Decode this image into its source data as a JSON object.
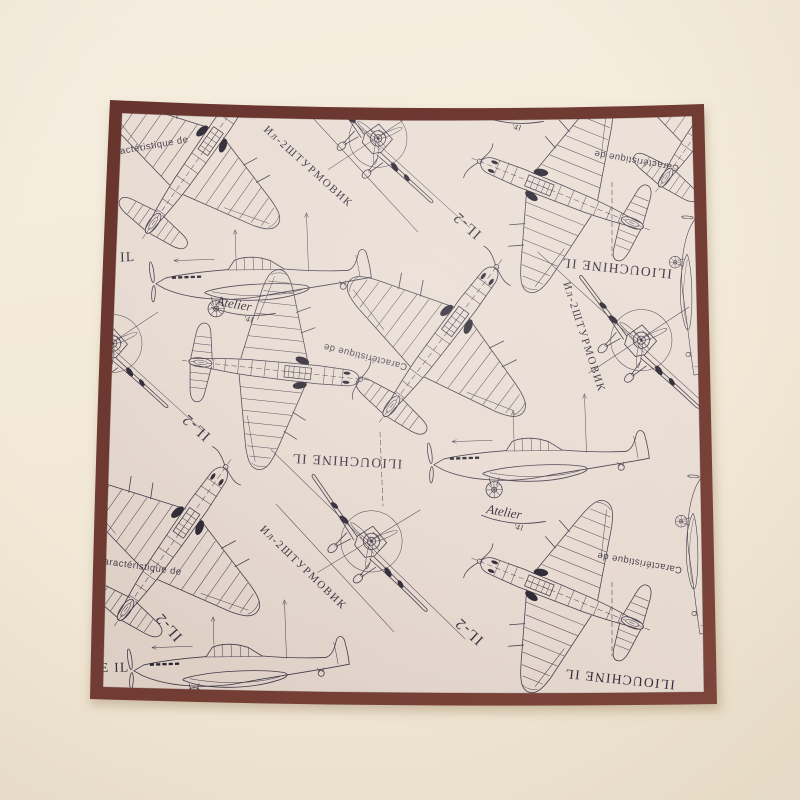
{
  "scene": {
    "type": "product photograph",
    "subject": "pocket square handkerchief with aircraft blueprint print, laid flat on a cream backdrop"
  },
  "colors": {
    "backdrop_top": "#f5eee0",
    "backdrop_bottom": "#eee4d1",
    "hem_border": "#6e3a32",
    "hem_border_light": "#7d453c",
    "fabric_light": "#ebdfd6",
    "fabric_dark": "#decfc5",
    "print_ink": "#3f3947",
    "print_ink_solid": "#27222e"
  },
  "print_texts": {
    "ilyouchine": "ILIOUCHINE IL",
    "ilyouchine_partial": "E IL",
    "shturmovik": "Ил-2ШТУРМОВИК",
    "caracteristique": "Caractéristique de",
    "il2": "IL-2",
    "signature": "Atelier",
    "signature_year": "'41"
  }
}
